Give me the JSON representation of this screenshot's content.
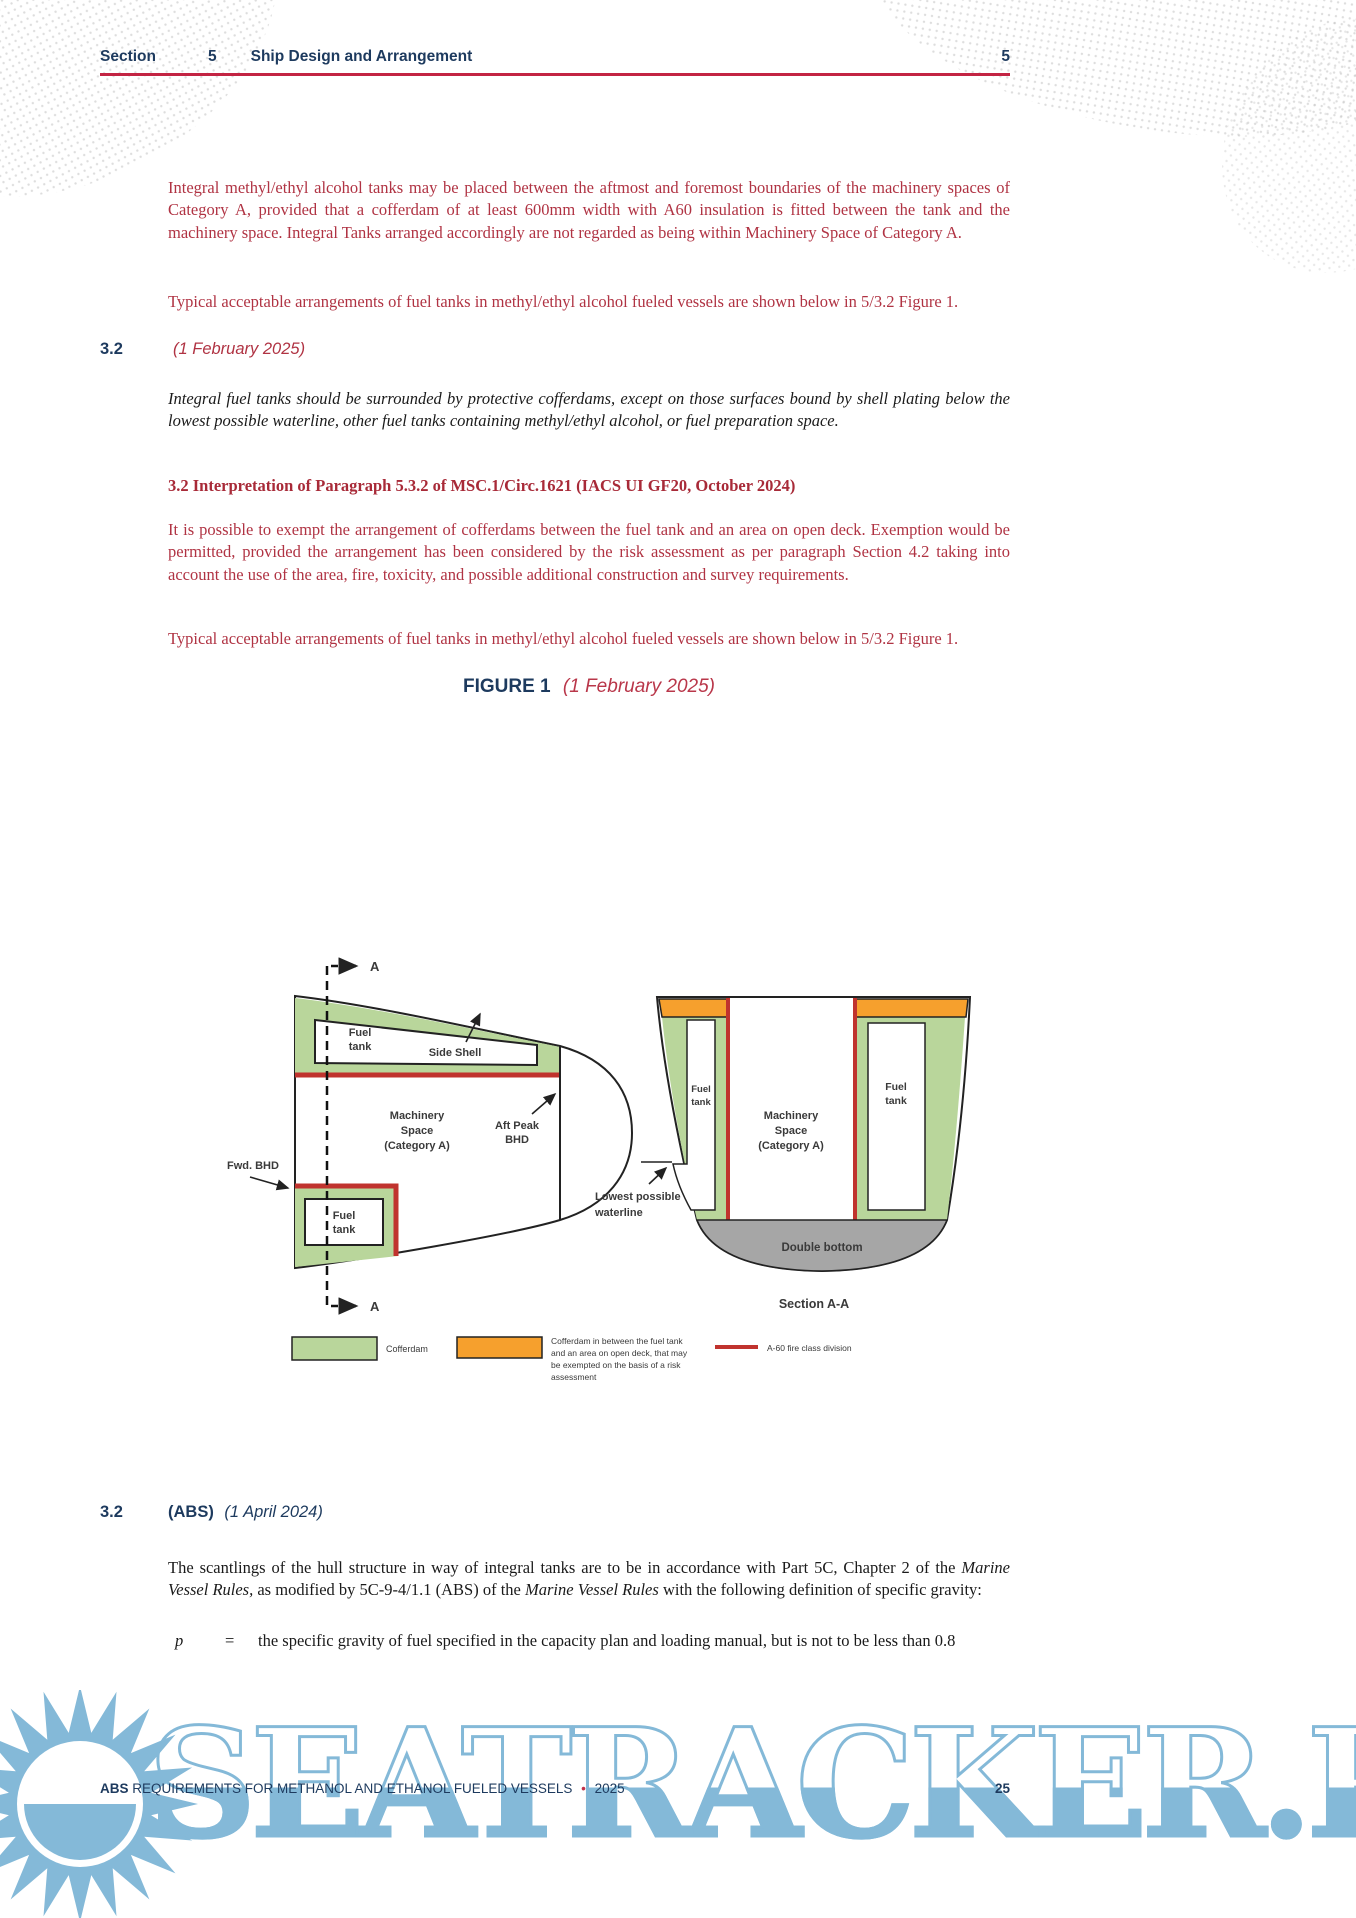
{
  "header": {
    "section_label": "Section",
    "section_number": "5",
    "title": "Ship Design and Arrangement",
    "page": "5"
  },
  "content": {
    "p1": "Integral methyl/ethyl alcohol tanks may be placed between the aftmost and foremost boundaries of the machinery spaces of Category A, provided that a cofferdam of at least 600mm width with A60 insulation is fitted between the tank and the machinery space. Integral Tanks arranged accordingly are not regarded as being within Machinery Space of Category A.",
    "p2": "Typical acceptable arrangements of fuel tanks in methyl/ethyl alcohol fueled vessels are shown below in 5/3.2 Figure 1.",
    "sec32_feb": {
      "number": "3.2",
      "date": "(1 February 2025)"
    },
    "p3": "Integral fuel tanks should be surrounded by protective cofferdams, except on those surfaces bound by shell plating below the lowest possible waterline, other fuel tanks containing methyl/ethyl alcohol, or fuel preparation space.",
    "interp_heading": "3.2 Interpretation of Paragraph 5.3.2 of MSC.1/Circ.1621 (IACS UI GF20, October 2024)",
    "p4": "It is possible to exempt the arrangement of cofferdams between the fuel tank and an area on open deck. Exemption would be permitted, provided the arrangement has been considered by the risk assessment as per paragraph Section 4.2 taking into account the use of the area, fire, toxicity, and possible additional construction and survey requirements.",
    "p5": "Typical acceptable arrangements of fuel tanks in methyl/ethyl alcohol fueled vessels are shown below in 5/3.2 Figure 1.",
    "sec32_abs": {
      "number": "3.2",
      "label": "(ABS)",
      "date": "(1 April 2024)"
    },
    "p6_runs": [
      {
        "t": "The scantlings of the hull structure in way of integral tanks are to be in accordance with Part 5C, Chapter 2 of the "
      },
      {
        "t": "Marine Vessel Rules,",
        "i": true
      },
      {
        "t": " as modified by 5C-9-4/1.1 (ABS) of the "
      },
      {
        "t": "Marine Vessel Rules",
        "i": true
      },
      {
        "t": " with the following definition of specific gravity:"
      }
    ],
    "definition": {
      "symbol": "p",
      "equals": "=",
      "text": "the specific gravity of fuel specified in the capacity plan and loading manual, but is not to be less than 0.8"
    }
  },
  "figure": {
    "title": {
      "label": "FIGURE 1",
      "date": "(1 February 2025)"
    },
    "labels": {
      "a_marker": "A",
      "fuel": "Fuel",
      "tank": "tank",
      "side_shell": "Side Shell",
      "machinery_1": "Machinery",
      "machinery_2": "Space",
      "machinery_3": "(Category A)",
      "aft_peak_1": "Aft Peak",
      "aft_peak_2": "BHD",
      "fwd_bhd": "Fwd. BHD",
      "lowest_1": "Lowest possible",
      "lowest_2": "waterline",
      "double_bottom": "Double bottom",
      "section_aa": "Section A-A"
    },
    "legend": {
      "cofferdam": "Cofferdam",
      "orange_1": "Cofferdam in between the fuel tank",
      "orange_2": "and an area on open deck, that may",
      "orange_3": "be exempted on the basis of a risk",
      "orange_4": "assessment",
      "a60": "A-60 fire class division"
    },
    "colors": {
      "cofferdam_green": "#b9d69b",
      "exempt_orange": "#f6a02d",
      "a60_red": "#c0332e",
      "double_bottom_gray": "#a6a6a6"
    }
  },
  "footer": {
    "brand": "ABS",
    "rest": "REQUIREMENTS FOR METHANOL AND ETHANOL FUELED VESSELS",
    "bullet": "•",
    "year": "2025",
    "page": "25"
  },
  "watermark": {
    "text": "SEATRACKER.RU"
  },
  "theme": {
    "body_red": "#b03343",
    "heading_navy": "#1d3a5e",
    "rule_red": "#c32443",
    "watermark_blue": "#84b9d8"
  }
}
